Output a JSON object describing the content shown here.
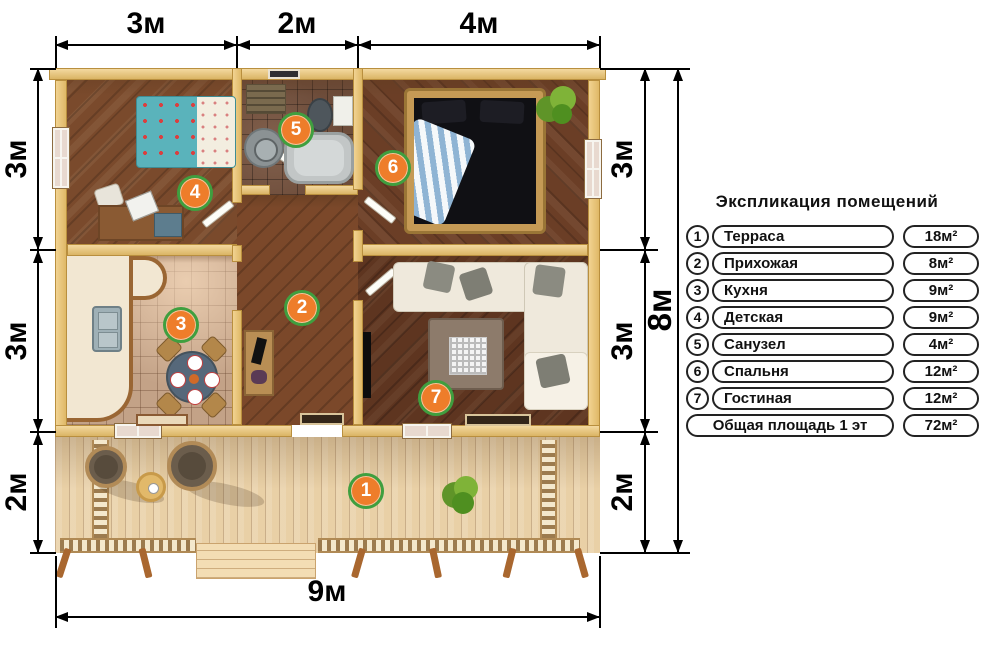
{
  "legend": {
    "title": "Экспликация помещений",
    "rows": [
      {
        "num": "1",
        "name": "Терраса",
        "area": "18м²"
      },
      {
        "num": "2",
        "name": "Прихожая",
        "area": "8м²"
      },
      {
        "num": "3",
        "name": "Кухня",
        "area": "9м²"
      },
      {
        "num": "4",
        "name": "Детская",
        "area": "9м²"
      },
      {
        "num": "5",
        "name": "Санузел",
        "area": "4м²"
      },
      {
        "num": "6",
        "name": "Спальня",
        "area": "12м²"
      },
      {
        "num": "7",
        "name": "Гостиная",
        "area": "12м²"
      }
    ],
    "total": {
      "name": "Общая площадь 1 эт",
      "area": "72м²"
    }
  },
  "dimensions": {
    "top": [
      "3м",
      "2м",
      "4м"
    ],
    "left": [
      "3м",
      "3м",
      "2м"
    ],
    "right": [
      "3м",
      "3м",
      "2м"
    ],
    "right_total": "8м",
    "bottom": "9м"
  },
  "badges": [
    "1",
    "2",
    "3",
    "4",
    "5",
    "6",
    "7"
  ],
  "colors": {
    "badge_fill": "#ee7d2a",
    "badge_ring": "#3f9f3f",
    "wall": "#edc46d"
  }
}
